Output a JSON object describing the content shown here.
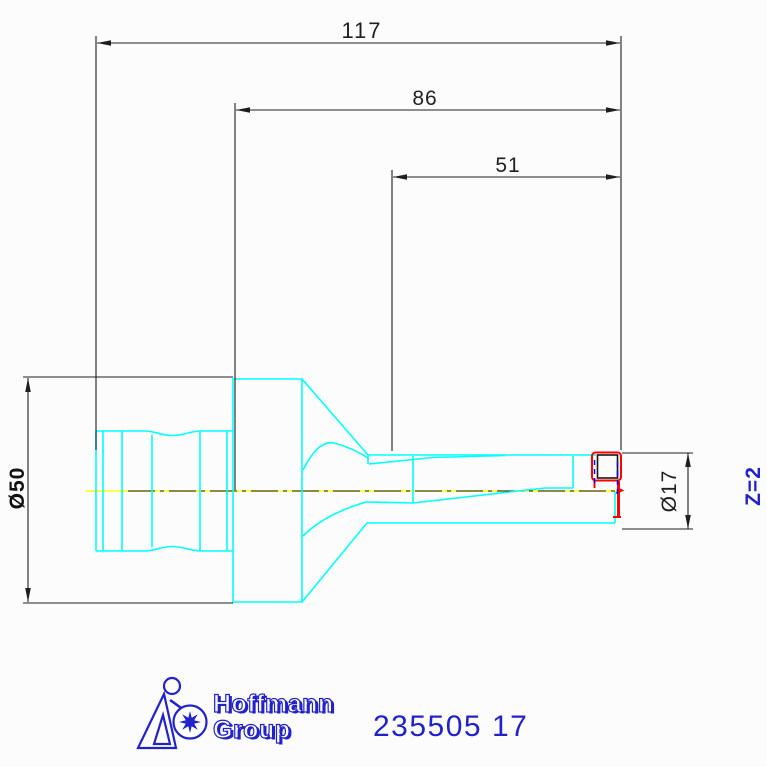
{
  "dimensions": {
    "overall_length": "117",
    "body_length": "86",
    "cutting_length": "51",
    "flange_diameter": "Ø50",
    "cutting_diameter": "Ø17",
    "teeth_count": "Z=2"
  },
  "branding": {
    "logo_text_line1": "Hoffmann",
    "logo_text_line2": "Group",
    "article_number": "235505 17"
  },
  "colors": {
    "part_outline": "#00ffff",
    "centerline": "#ffff00",
    "insert_highlight": "#ff0000",
    "hidden_edge": "#0000ff",
    "dimension_lines": "#1f1f1f",
    "brand_blue": "#2222cc",
    "background": "#fcfcfc"
  }
}
